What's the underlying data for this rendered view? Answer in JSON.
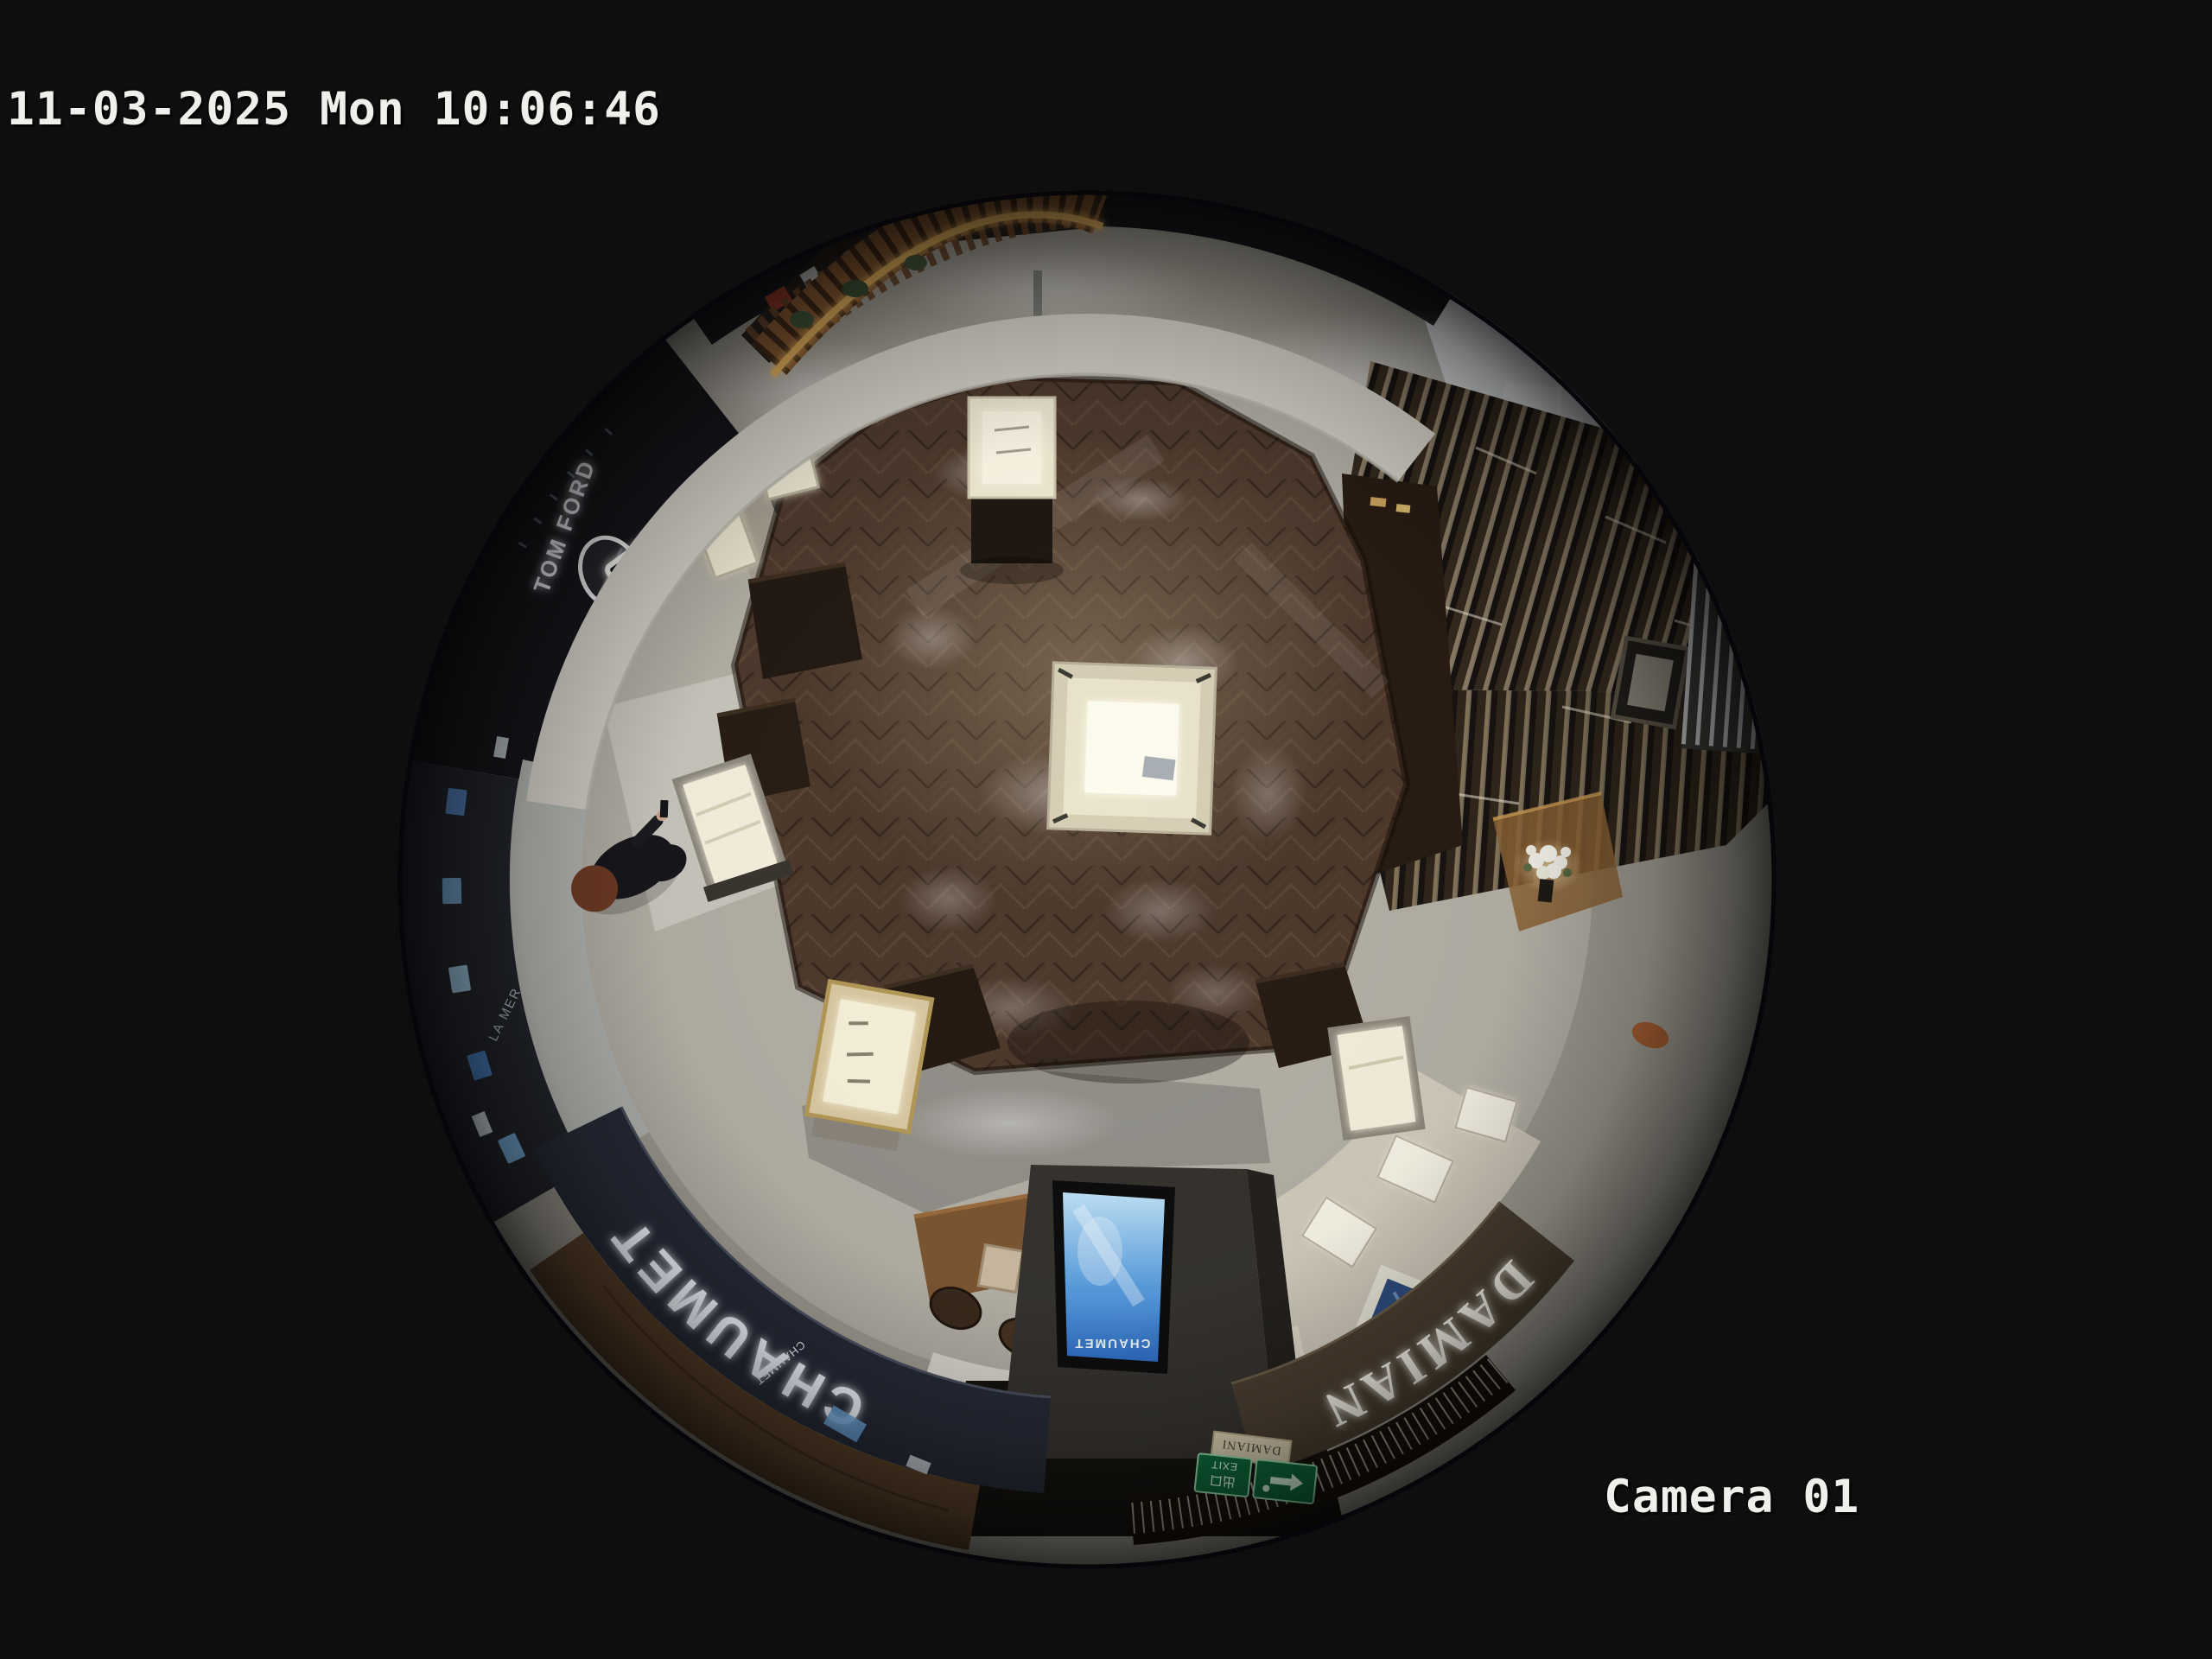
{
  "osd": {
    "timestamp": "11-03-2025 Mon 10:06:46",
    "camera_label": "Camera 01",
    "text_color": "#efefeb"
  },
  "scene": {
    "store_signs": {
      "chaumet": "CHAUMET",
      "chaumet_small": "CHAUMET",
      "chaumet_screen": "CHAUMET",
      "damiani": "DAMIANI",
      "damiani_plaque": "DAMIANI",
      "tom_ford": "TOM FORD",
      "tf_monogram": "TF",
      "la_mer": "LA MER",
      "exit_cn": "出口",
      "exit_en": "EXIT"
    },
    "colors": {
      "chaumet_fascia": "#262b37",
      "damiani_fascia": "#4a3e30",
      "exit_green": "#0e6b3c",
      "screen_blue_light": "#bfe2f7",
      "screen_blue_mid": "#5a9ede",
      "screen_blue_dark": "#2f6ec6",
      "wood_floor": "#4e3a2d",
      "kiosk_wood": "#8a5c34",
      "kiosk_glow": "#f0bc62",
      "person_hair": "#6e3b24",
      "person_coat": "#17171c"
    }
  }
}
